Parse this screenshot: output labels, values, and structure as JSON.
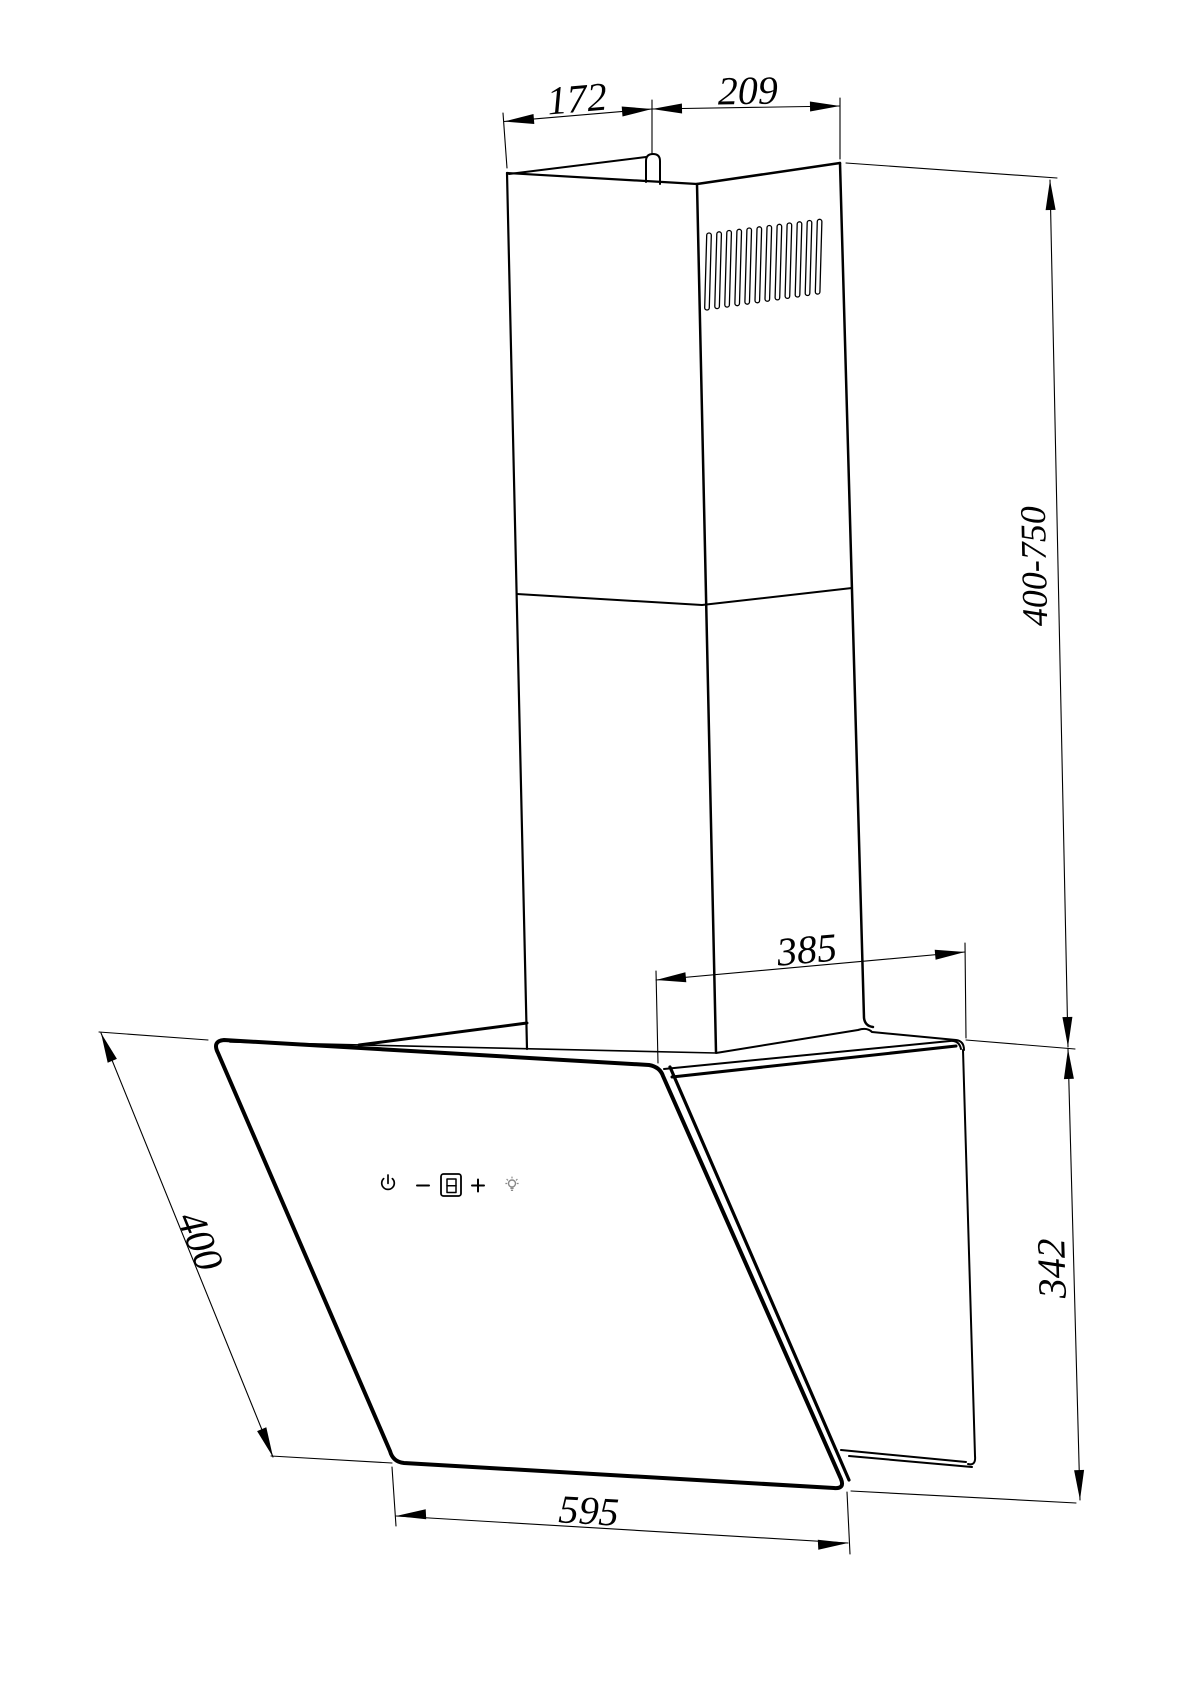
{
  "diagram": {
    "dimensions": {
      "chimney_front_width": "172",
      "chimney_side_width": "209",
      "chimney_height_range": "400-750",
      "top_depth": "385",
      "rear_height": "342",
      "panel_slant_height": "400",
      "body_width": "595"
    },
    "control_panel": {
      "display_value": "8",
      "icons": [
        "power-icon",
        "minus-icon",
        "segment-display",
        "plus-icon",
        "light-icon"
      ]
    },
    "colors": {
      "line": "#000000",
      "background": "#ffffff",
      "light_icon": "#8a8a8a"
    }
  }
}
